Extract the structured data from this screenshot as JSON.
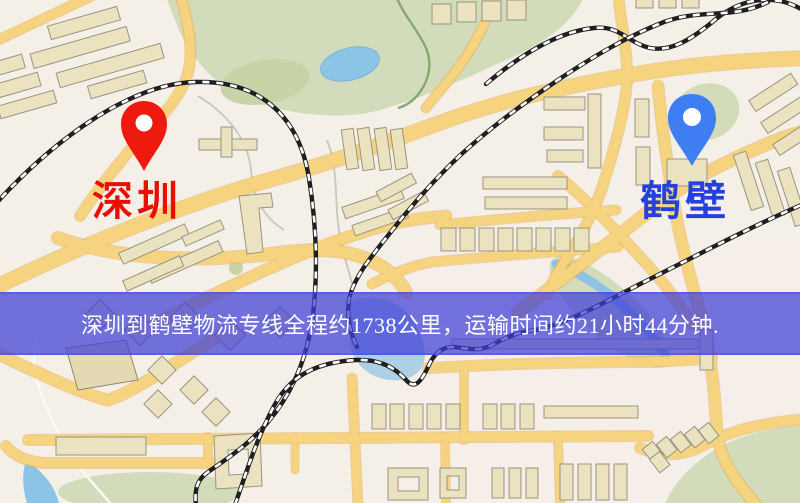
{
  "map": {
    "origin": {
      "label": "深圳",
      "pin_color": "#ee1a0e",
      "label_color": "#e81006"
    },
    "destination": {
      "label": "鹤壁",
      "pin_color": "#3e7ef2",
      "label_color": "#2442da"
    },
    "banner": {
      "text": "深圳到鹤壁物流专线全程约1738公里，运输时间约21小时44分钟.",
      "distance_km": "1738",
      "duration": "21小时44分钟",
      "background_color": "#3e3ed7",
      "text_color": "#ffffff"
    },
    "colors": {
      "background": "#f5f0e7",
      "road": "#f6d37e",
      "railway": "#1f1f1f",
      "water": "#8cc4e6",
      "park": "#d3dcba",
      "building": "#ebe2c0"
    }
  }
}
